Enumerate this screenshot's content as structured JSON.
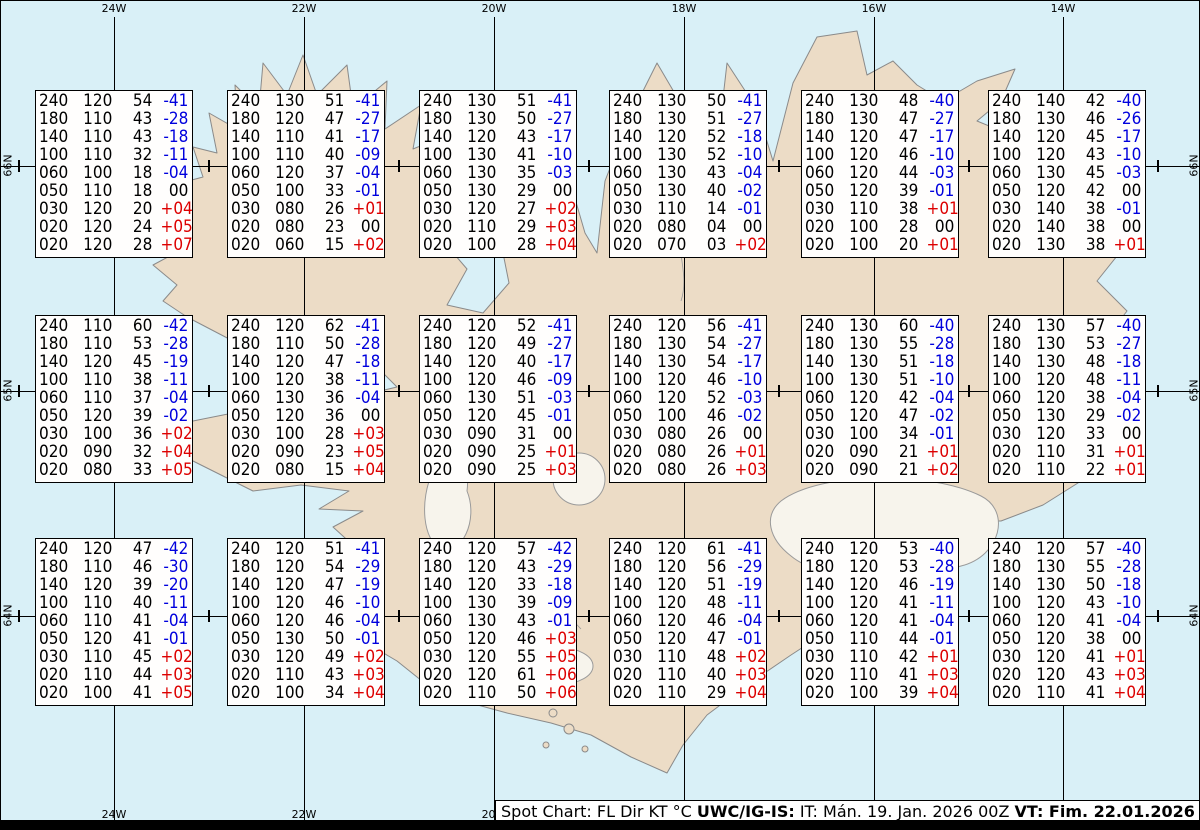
{
  "title_legend": "Spot Chart: FL Dir KT °C",
  "colors": {
    "sea": "#d9f0f7",
    "land": "#ecdcc6",
    "coast": "#8a8a8a",
    "temp_negative": "#0000dd",
    "temp_positive": "#dd0000",
    "text": "#000000"
  },
  "grid": {
    "meridian_labels": [
      "24W",
      "22W",
      "20W",
      "18W",
      "16W",
      "14W"
    ],
    "parallel_labels": [
      "66N",
      "65N",
      "64N"
    ]
  },
  "stations": {
    "columns": [
      "FL",
      "Dir",
      "KT",
      "°C"
    ],
    "boxes": [
      {
        "rows": [
          [
            "240",
            "120",
            "54",
            "-41"
          ],
          [
            "180",
            "110",
            "43",
            "-28"
          ],
          [
            "140",
            "110",
            "43",
            "-18"
          ],
          [
            "100",
            "110",
            "32",
            "-11"
          ],
          [
            "060",
            "100",
            "18",
            "-04"
          ],
          [
            "050",
            "110",
            "18",
            "00"
          ],
          [
            "030",
            "120",
            "20",
            "+04"
          ],
          [
            "020",
            "120",
            "24",
            "+05"
          ],
          [
            "020",
            "120",
            "28",
            "+07"
          ]
        ]
      },
      {
        "rows": [
          [
            "240",
            "130",
            "51",
            "-41"
          ],
          [
            "180",
            "120",
            "47",
            "-27"
          ],
          [
            "140",
            "110",
            "41",
            "-17"
          ],
          [
            "100",
            "110",
            "40",
            "-09"
          ],
          [
            "060",
            "120",
            "37",
            "-04"
          ],
          [
            "050",
            "100",
            "33",
            "-01"
          ],
          [
            "030",
            "080",
            "26",
            "+01"
          ],
          [
            "020",
            "080",
            "23",
            "00"
          ],
          [
            "020",
            "060",
            "15",
            "+02"
          ]
        ]
      },
      {
        "rows": [
          [
            "240",
            "130",
            "51",
            "-41"
          ],
          [
            "180",
            "130",
            "50",
            "-27"
          ],
          [
            "140",
            "120",
            "43",
            "-17"
          ],
          [
            "100",
            "130",
            "41",
            "-10"
          ],
          [
            "060",
            "130",
            "35",
            "-03"
          ],
          [
            "050",
            "130",
            "29",
            "00"
          ],
          [
            "030",
            "120",
            "27",
            "+02"
          ],
          [
            "020",
            "110",
            "29",
            "+03"
          ],
          [
            "020",
            "100",
            "28",
            "+04"
          ]
        ]
      },
      {
        "rows": [
          [
            "240",
            "130",
            "50",
            "-41"
          ],
          [
            "180",
            "130",
            "51",
            "-27"
          ],
          [
            "140",
            "120",
            "52",
            "-18"
          ],
          [
            "100",
            "130",
            "52",
            "-10"
          ],
          [
            "060",
            "130",
            "43",
            "-04"
          ],
          [
            "050",
            "130",
            "40",
            "-02"
          ],
          [
            "030",
            "110",
            "14",
            "-01"
          ],
          [
            "020",
            "080",
            "04",
            "00"
          ],
          [
            "020",
            "070",
            "03",
            "+02"
          ]
        ]
      },
      {
        "rows": [
          [
            "240",
            "130",
            "48",
            "-40"
          ],
          [
            "180",
            "130",
            "47",
            "-27"
          ],
          [
            "140",
            "120",
            "47",
            "-17"
          ],
          [
            "100",
            "120",
            "46",
            "-10"
          ],
          [
            "060",
            "120",
            "44",
            "-03"
          ],
          [
            "050",
            "120",
            "39",
            "-01"
          ],
          [
            "030",
            "110",
            "38",
            "+01"
          ],
          [
            "020",
            "100",
            "28",
            "00"
          ],
          [
            "020",
            "100",
            "20",
            "+01"
          ]
        ]
      },
      {
        "rows": [
          [
            "240",
            "140",
            "42",
            "-40"
          ],
          [
            "180",
            "130",
            "46",
            "-26"
          ],
          [
            "140",
            "120",
            "45",
            "-17"
          ],
          [
            "100",
            "120",
            "43",
            "-10"
          ],
          [
            "060",
            "130",
            "45",
            "-03"
          ],
          [
            "050",
            "120",
            "42",
            "00"
          ],
          [
            "030",
            "140",
            "38",
            "-01"
          ],
          [
            "020",
            "140",
            "38",
            "00"
          ],
          [
            "020",
            "130",
            "38",
            "+01"
          ]
        ]
      },
      {
        "rows": [
          [
            "240",
            "110",
            "60",
            "-42"
          ],
          [
            "180",
            "110",
            "53",
            "-28"
          ],
          [
            "140",
            "120",
            "45",
            "-19"
          ],
          [
            "100",
            "110",
            "38",
            "-11"
          ],
          [
            "060",
            "110",
            "37",
            "-04"
          ],
          [
            "050",
            "120",
            "39",
            "-02"
          ],
          [
            "030",
            "100",
            "36",
            "+02"
          ],
          [
            "020",
            "090",
            "32",
            "+04"
          ],
          [
            "020",
            "080",
            "33",
            "+05"
          ]
        ]
      },
      {
        "rows": [
          [
            "240",
            "120",
            "62",
            "-41"
          ],
          [
            "180",
            "110",
            "50",
            "-28"
          ],
          [
            "140",
            "120",
            "47",
            "-18"
          ],
          [
            "100",
            "120",
            "38",
            "-11"
          ],
          [
            "060",
            "130",
            "36",
            "-04"
          ],
          [
            "050",
            "120",
            "36",
            "00"
          ],
          [
            "030",
            "100",
            "28",
            "+03"
          ],
          [
            "020",
            "090",
            "23",
            "+05"
          ],
          [
            "020",
            "080",
            "15",
            "+04"
          ]
        ]
      },
      {
        "rows": [
          [
            "240",
            "120",
            "52",
            "-41"
          ],
          [
            "180",
            "120",
            "49",
            "-27"
          ],
          [
            "140",
            "120",
            "40",
            "-17"
          ],
          [
            "100",
            "120",
            "46",
            "-09"
          ],
          [
            "060",
            "130",
            "51",
            "-03"
          ],
          [
            "050",
            "120",
            "45",
            "-01"
          ],
          [
            "030",
            "090",
            "31",
            "00"
          ],
          [
            "020",
            "090",
            "25",
            "+01"
          ],
          [
            "020",
            "090",
            "25",
            "+03"
          ]
        ]
      },
      {
        "rows": [
          [
            "240",
            "120",
            "56",
            "-41"
          ],
          [
            "180",
            "130",
            "54",
            "-27"
          ],
          [
            "140",
            "130",
            "54",
            "-17"
          ],
          [
            "100",
            "120",
            "46",
            "-10"
          ],
          [
            "060",
            "120",
            "52",
            "-03"
          ],
          [
            "050",
            "100",
            "46",
            "-02"
          ],
          [
            "030",
            "080",
            "26",
            "00"
          ],
          [
            "020",
            "080",
            "26",
            "+01"
          ],
          [
            "020",
            "080",
            "26",
            "+03"
          ]
        ]
      },
      {
        "rows": [
          [
            "240",
            "130",
            "60",
            "-40"
          ],
          [
            "180",
            "130",
            "55",
            "-28"
          ],
          [
            "140",
            "130",
            "51",
            "-18"
          ],
          [
            "100",
            "130",
            "51",
            "-10"
          ],
          [
            "060",
            "120",
            "42",
            "-04"
          ],
          [
            "050",
            "120",
            "47",
            "-02"
          ],
          [
            "030",
            "100",
            "34",
            "-01"
          ],
          [
            "020",
            "090",
            "21",
            "+01"
          ],
          [
            "020",
            "090",
            "21",
            "+02"
          ]
        ]
      },
      {
        "rows": [
          [
            "240",
            "130",
            "57",
            "-40"
          ],
          [
            "180",
            "130",
            "53",
            "-27"
          ],
          [
            "140",
            "130",
            "48",
            "-18"
          ],
          [
            "100",
            "120",
            "48",
            "-11"
          ],
          [
            "060",
            "120",
            "38",
            "-04"
          ],
          [
            "050",
            "130",
            "29",
            "-02"
          ],
          [
            "030",
            "120",
            "33",
            "00"
          ],
          [
            "020",
            "110",
            "31",
            "+01"
          ],
          [
            "020",
            "110",
            "22",
            "+01"
          ]
        ]
      },
      {
        "rows": [
          [
            "240",
            "120",
            "47",
            "-42"
          ],
          [
            "180",
            "110",
            "46",
            "-30"
          ],
          [
            "140",
            "120",
            "39",
            "-20"
          ],
          [
            "100",
            "110",
            "40",
            "-11"
          ],
          [
            "060",
            "110",
            "41",
            "-04"
          ],
          [
            "050",
            "120",
            "41",
            "-01"
          ],
          [
            "030",
            "110",
            "45",
            "+02"
          ],
          [
            "020",
            "110",
            "44",
            "+03"
          ],
          [
            "020",
            "100",
            "41",
            "+05"
          ]
        ]
      },
      {
        "rows": [
          [
            "240",
            "120",
            "51",
            "-41"
          ],
          [
            "180",
            "120",
            "54",
            "-29"
          ],
          [
            "140",
            "120",
            "47",
            "-19"
          ],
          [
            "100",
            "120",
            "46",
            "-10"
          ],
          [
            "060",
            "120",
            "46",
            "-04"
          ],
          [
            "050",
            "130",
            "50",
            "-01"
          ],
          [
            "030",
            "120",
            "49",
            "+02"
          ],
          [
            "020",
            "110",
            "43",
            "+03"
          ],
          [
            "020",
            "100",
            "34",
            "+04"
          ]
        ]
      },
      {
        "rows": [
          [
            "240",
            "120",
            "57",
            "-42"
          ],
          [
            "180",
            "120",
            "43",
            "-29"
          ],
          [
            "140",
            "120",
            "33",
            "-18"
          ],
          [
            "100",
            "130",
            "39",
            "-09"
          ],
          [
            "060",
            "130",
            "43",
            "-01"
          ],
          [
            "050",
            "120",
            "46",
            "+03"
          ],
          [
            "030",
            "120",
            "55",
            "+05"
          ],
          [
            "020",
            "120",
            "61",
            "+06"
          ],
          [
            "020",
            "110",
            "50",
            "+06"
          ]
        ]
      },
      {
        "rows": [
          [
            "240",
            "120",
            "61",
            "-41"
          ],
          [
            "180",
            "120",
            "56",
            "-29"
          ],
          [
            "140",
            "120",
            "51",
            "-19"
          ],
          [
            "100",
            "120",
            "48",
            "-11"
          ],
          [
            "060",
            "120",
            "46",
            "-04"
          ],
          [
            "050",
            "120",
            "47",
            "-01"
          ],
          [
            "030",
            "110",
            "48",
            "+02"
          ],
          [
            "020",
            "110",
            "40",
            "+03"
          ],
          [
            "020",
            "110",
            "29",
            "+04"
          ]
        ]
      },
      {
        "rows": [
          [
            "240",
            "120",
            "53",
            "-40"
          ],
          [
            "180",
            "120",
            "53",
            "-28"
          ],
          [
            "140",
            "120",
            "46",
            "-19"
          ],
          [
            "100",
            "120",
            "41",
            "-11"
          ],
          [
            "060",
            "120",
            "41",
            "-04"
          ],
          [
            "050",
            "110",
            "44",
            "-01"
          ],
          [
            "030",
            "110",
            "42",
            "+01"
          ],
          [
            "020",
            "110",
            "41",
            "+03"
          ],
          [
            "020",
            "100",
            "39",
            "+04"
          ]
        ]
      },
      {
        "rows": [
          [
            "240",
            "120",
            "57",
            "-40"
          ],
          [
            "180",
            "130",
            "55",
            "-28"
          ],
          [
            "140",
            "130",
            "50",
            "-18"
          ],
          [
            "100",
            "120",
            "43",
            "-10"
          ],
          [
            "060",
            "120",
            "41",
            "-04"
          ],
          [
            "050",
            "120",
            "38",
            "00"
          ],
          [
            "030",
            "120",
            "41",
            "+01"
          ],
          [
            "020",
            "120",
            "43",
            "+03"
          ],
          [
            "020",
            "110",
            "41",
            "+04"
          ]
        ]
      }
    ]
  },
  "footer": {
    "segments": [
      {
        "text": "Spot Chart: FL Dir KT °C ",
        "bold": false
      },
      {
        "text": "UWC/IG-IS:",
        "bold": true
      },
      {
        "text": " IT: Mán. 19. Jan. 2026 00Z ",
        "bold": false
      },
      {
        "text": "VT: Fim. 22.01.2026 00Z",
        "bold": true
      },
      {
        "text": " (+72 h)",
        "bold": false
      }
    ]
  }
}
